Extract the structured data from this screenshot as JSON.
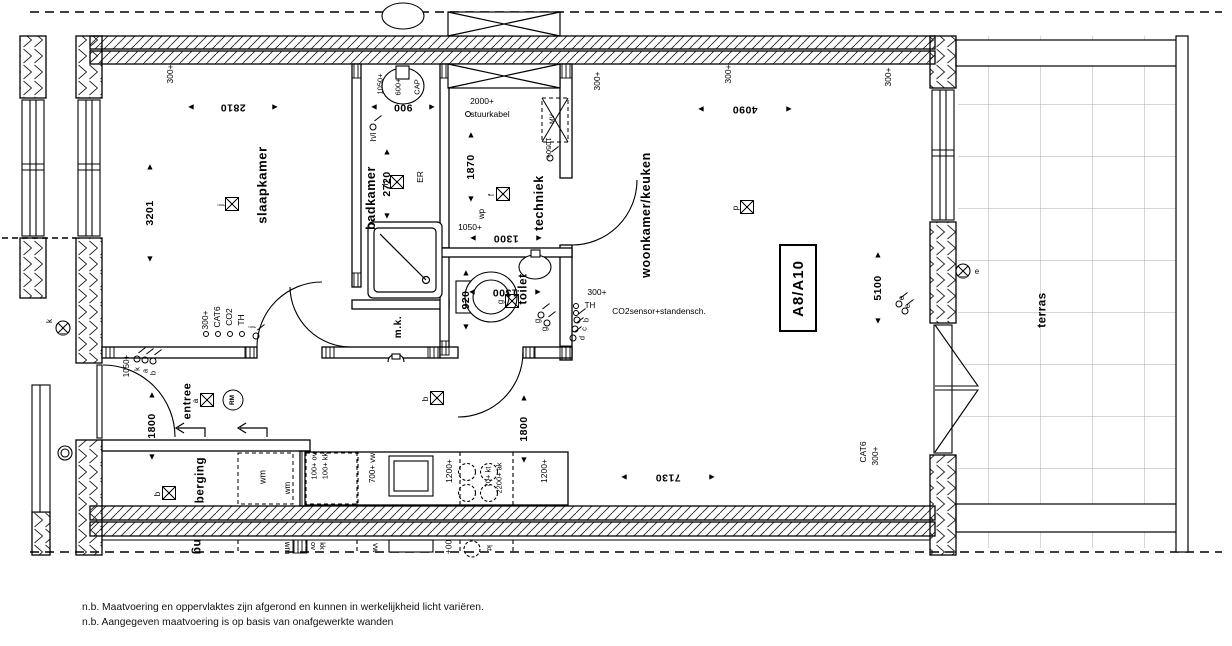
{
  "title_block": {
    "unit": "A8/A10"
  },
  "notes": [
    "n.b. Maatvoering en oppervlaktes zijn afgerond en kunnen in werkelijkheid licht variëren.",
    "n.b. Aangegeven maatvoering is op basis van onafgewerkte wanden"
  ],
  "labels": [
    {
      "t": "slaapkamer",
      "x": 262,
      "y": 185,
      "fs": 13,
      "cls": "room",
      "n": "room-label-slaapkamer"
    },
    {
      "t": "badkamer",
      "x": 371,
      "y": 198,
      "fs": 12.5,
      "cls": "room",
      "n": "room-label-badkamer"
    },
    {
      "t": "techniek",
      "x": 539,
      "y": 203,
      "fs": 12.5,
      "cls": "room",
      "n": "room-label-techniek"
    },
    {
      "t": "toilet",
      "x": 524,
      "y": 289,
      "fs": 11.5,
      "cls": "room",
      "n": "room-label-toilet"
    },
    {
      "t": "m.k.",
      "x": 399,
      "y": 327,
      "fs": 10,
      "cls": "room",
      "n": "room-label-mk"
    },
    {
      "t": "entree",
      "x": 188,
      "y": 401,
      "fs": 11,
      "cls": "room",
      "n": "room-label-entree"
    },
    {
      "t": "berging",
      "x": 201,
      "y": 480,
      "fs": 11.5,
      "cls": "room",
      "n": "room-label-berging"
    },
    {
      "t": "woonkamer/keuken",
      "x": 646,
      "y": 215,
      "fs": 12.5,
      "cls": "room",
      "n": "room-label-woonkamer-keuken"
    },
    {
      "t": "terras",
      "x": 1043,
      "y": 310,
      "fs": 11.5,
      "cls": "room",
      "n": "room-label-terras"
    },
    {
      "t": "300+",
      "x": 170,
      "y": 74
    },
    {
      "t": "300+",
      "x": 728,
      "y": 74
    },
    {
      "t": "300+",
      "x": 597,
      "y": 81
    },
    {
      "t": "300+",
      "x": 888,
      "y": 77
    },
    {
      "t": "300+",
      "x": 205,
      "y": 320
    },
    {
      "t": "CAT6",
      "x": 217,
      "y": 317
    },
    {
      "t": "CO2",
      "x": 229,
      "y": 317
    },
    {
      "t": "TH",
      "x": 241,
      "y": 320
    },
    {
      "t": "j",
      "x": 252,
      "y": 327,
      "fs": 8
    },
    {
      "t": "1050+",
      "x": 127,
      "y": 366,
      "fs": 8
    },
    {
      "t": "k",
      "x": 137,
      "y": 369,
      "fs": 7.5
    },
    {
      "t": "a",
      "x": 145,
      "y": 371,
      "fs": 7.5
    },
    {
      "t": "b",
      "x": 153,
      "y": 373,
      "fs": 7.5
    },
    {
      "t": "h/l",
      "x": 374,
      "y": 137,
      "fs": 8
    },
    {
      "t": "ER",
      "x": 420,
      "y": 177,
      "fs": 8.5
    },
    {
      "t": "1050+",
      "x": 380,
      "y": 84,
      "fs": 7.5
    },
    {
      "t": "600+",
      "x": 398,
      "y": 87,
      "fs": 7.5
    },
    {
      "t": "CAP",
      "x": 417,
      "y": 87,
      "fs": 7.5
    },
    {
      "t": "2000+",
      "x": 482,
      "y": 101,
      "r": 0,
      "fs": 8.5
    },
    {
      "t": "stuurkabel",
      "x": 490,
      "y": 114,
      "r": 0,
      "fs": 8.5
    },
    {
      "t": "1050+",
      "x": 548,
      "y": 148,
      "r": 90,
      "fs": 7.5
    },
    {
      "t": "wp",
      "x": 482,
      "y": 214,
      "fs": 8
    },
    {
      "t": "1050+",
      "x": 470,
      "y": 227,
      "r": 0,
      "fs": 8.5
    },
    {
      "t": "MV",
      "x": 553,
      "y": 119,
      "fs": 6.5
    },
    {
      "t": "g",
      "x": 538,
      "y": 321,
      "fs": 8
    },
    {
      "t": "g",
      "x": 545,
      "y": 329,
      "fs": 8
    },
    {
      "t": "300+",
      "x": 597,
      "y": 292,
      "r": 0
    },
    {
      "t": "TH",
      "x": 590,
      "y": 306,
      "r": 0,
      "fs": 8
    },
    {
      "t": "CO2sensor+standensch.",
      "x": 659,
      "y": 311,
      "r": 0,
      "fs": 8.5
    },
    {
      "t": "b",
      "x": 586,
      "y": 320,
      "fs": 7.5
    },
    {
      "t": "c",
      "x": 584,
      "y": 329,
      "fs": 7.5
    },
    {
      "t": "d",
      "x": 582,
      "y": 338,
      "fs": 7.5
    },
    {
      "t": "e",
      "x": 902,
      "y": 298,
      "fs": 8
    },
    {
      "t": "e",
      "x": 908,
      "y": 306,
      "fs": 8
    },
    {
      "t": "k",
      "x": 50,
      "y": 321,
      "fs": 8
    },
    {
      "t": "e",
      "x": 977,
      "y": 272,
      "r": 0,
      "fs": 8
    },
    {
      "t": "wm",
      "x": 263,
      "y": 477,
      "fs": 9
    },
    {
      "t": "wm",
      "x": 288,
      "y": 488,
      "fs": 8
    },
    {
      "t": "100+ ov",
      "x": 314,
      "y": 466,
      "fs": 7.5
    },
    {
      "t": "100+ kk",
      "x": 325,
      "y": 466,
      "fs": 7.5
    },
    {
      "t": "700+ vw",
      "x": 373,
      "y": 468,
      "fs": 8
    },
    {
      "t": "1200+",
      "x": 449,
      "y": 471,
      "fs": 8.5
    },
    {
      "t": "70+ kt",
      "x": 488,
      "y": 477,
      "fs": 7.5
    },
    {
      "t": "2200+ ak",
      "x": 499,
      "y": 478,
      "fs": 7.5
    },
    {
      "t": "1200+",
      "x": 544,
      "y": 471,
      "fs": 8.5
    },
    {
      "t": "CAT6",
      "x": 863,
      "y": 452,
      "fs": 8.5
    },
    {
      "t": "300+",
      "x": 875,
      "y": 456,
      "fs": 8.5
    },
    {
      "t": "ng",
      "x": 198,
      "y": 547,
      "r": 90,
      "fs": 12,
      "cls": "room",
      "n": "mirrored-label-berging"
    },
    {
      "t": "wm",
      "x": 287,
      "y": 548,
      "r": 90,
      "fs": 8,
      "n": "mirrored-label-wm"
    },
    {
      "t": "ov",
      "x": 313,
      "y": 546,
      "r": 90,
      "fs": 7.5,
      "n": "mirrored-label-ov"
    },
    {
      "t": "kk",
      "x": 322,
      "y": 546,
      "r": 90,
      "fs": 7.5,
      "n": "mirrored-label-kk"
    },
    {
      "t": "vw",
      "x": 375,
      "y": 548,
      "r": 90,
      "fs": 8,
      "n": "mirrored-label-vw"
    },
    {
      "t": "00+",
      "x": 448,
      "y": 547,
      "r": 90,
      "fs": 8.5,
      "n": "mirrored-label-00"
    },
    {
      "t": "kt",
      "x": 489,
      "y": 548,
      "r": 90,
      "fs": 7.5,
      "n": "mirrored-label-kt"
    }
  ],
  "dims": [
    {
      "v": "2810",
      "x": 233,
      "y": 107,
      "o": "h",
      "len": 84
    },
    {
      "v": "900",
      "x": 403,
      "y": 107,
      "o": "h",
      "len": 58
    },
    {
      "v": "4090",
      "x": 745,
      "y": 109,
      "o": "h",
      "len": 88
    },
    {
      "v": "1300",
      "x": 506,
      "y": 238,
      "o": "h",
      "len": 66
    },
    {
      "v": "1300",
      "x": 505,
      "y": 292,
      "o": "h",
      "len": 66
    },
    {
      "v": "7130",
      "x": 668,
      "y": 477,
      "o": "h",
      "len": 88
    },
    {
      "v": "3201",
      "x": 150,
      "y": 213,
      "o": "v",
      "len": 92
    },
    {
      "v": "2720",
      "x": 387,
      "y": 184,
      "o": "v",
      "len": 64
    },
    {
      "v": "1870",
      "x": 471,
      "y": 167,
      "o": "v",
      "len": 64
    },
    {
      "v": "920",
      "x": 466,
      "y": 300,
      "o": "v",
      "len": 54
    },
    {
      "v": "5100",
      "x": 878,
      "y": 288,
      "o": "v",
      "len": 66
    },
    {
      "v": "1800",
      "x": 152,
      "y": 426,
      "o": "v",
      "len": 62
    },
    {
      "v": "1800",
      "x": 524,
      "y": 429,
      "o": "v",
      "len": 62
    }
  ],
  "ceiling_lights": [
    {
      "l": "j",
      "x": 232,
      "y": 204
    },
    {
      "l": "h",
      "x": 397,
      "y": 182
    },
    {
      "l": "f",
      "x": 503,
      "y": 194
    },
    {
      "l": "g",
      "x": 512,
      "y": 301
    },
    {
      "l": "p",
      "x": 747,
      "y": 207
    },
    {
      "l": "a",
      "x": 207,
      "y": 400
    },
    {
      "l": "b",
      "x": 169,
      "y": 493
    },
    {
      "l": "b",
      "x": 437,
      "y": 398
    }
  ],
  "switches": [
    {
      "x": 256,
      "y": 336
    },
    {
      "x": 137,
      "y": 359
    },
    {
      "x": 145,
      "y": 360
    },
    {
      "x": 153,
      "y": 361
    },
    {
      "x": 373,
      "y": 127
    },
    {
      "x": 550,
      "y": 158
    },
    {
      "x": 541,
      "y": 315
    },
    {
      "x": 547,
      "y": 323
    },
    {
      "x": 577,
      "y": 320
    },
    {
      "x": 575,
      "y": 329
    },
    {
      "x": 573,
      "y": 338
    },
    {
      "x": 899,
      "y": 304
    },
    {
      "x": 905,
      "y": 311
    }
  ],
  "dots": [
    {
      "x": 206,
      "y": 334
    },
    {
      "x": 218,
      "y": 334
    },
    {
      "x": 230,
      "y": 334
    },
    {
      "x": 242,
      "y": 334
    },
    {
      "x": 576,
      "y": 306
    },
    {
      "x": 576,
      "y": 313
    },
    {
      "x": 468,
      "y": 114
    }
  ],
  "smoke_detector": {
    "t": "RM",
    "x": 233,
    "y": 400
  }
}
